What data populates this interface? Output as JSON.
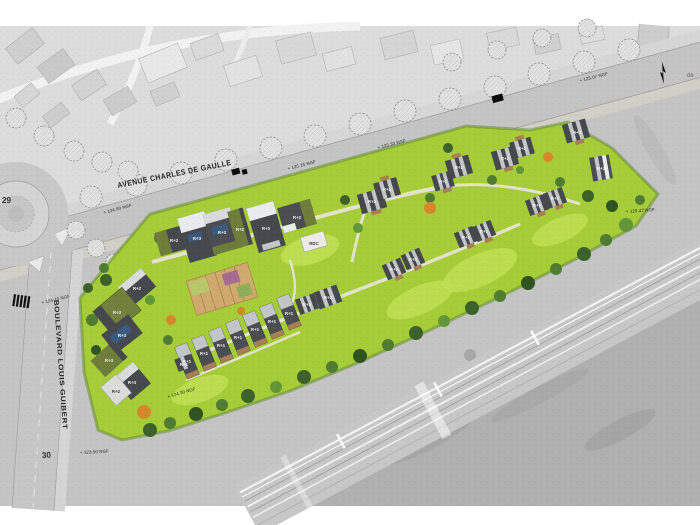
{
  "map": {
    "type": "architectural masterplan over grayscale aerial photo",
    "streets": {
      "avenue": "AVENUE CHARLES DE GAULLE",
      "boulevard": "BOULEVARD LOUIS GUIBERT",
      "roundabout_number": "29",
      "boulevard_number": "30",
      "right_edge_text": "de"
    },
    "elevation_markers": [
      "+ 124.90 NGF",
      "+ 125.15 NGF",
      "+ 125.33 NGF",
      "+ 125.07 NGF",
      "+ 125.47 NGF",
      "+ 124.70 NGF",
      "+ 124.30 NGF",
      "+ 123.50 NGF"
    ],
    "building_labels": [
      "R+2",
      "R+3",
      "R+3",
      "R+2",
      "R+3",
      "R+2",
      "RDC",
      "R+2",
      "R+2",
      "R+1",
      "R+2",
      "R+2",
      "R+2",
      "R+2",
      "R+3",
      "R+1",
      "R+1",
      "R+1",
      "R+1",
      "R+1",
      "R+1",
      "R+1",
      "R+2",
      "R+1",
      "R+1",
      "R+1",
      "R+1",
      "R+1",
      "R+1",
      "R+1",
      "R+2",
      "R+3",
      "R+3",
      "R+3",
      "R+3",
      "R+2",
      "R+1"
    ],
    "colors": {
      "site_green": "#a6cd37",
      "lawn_light": "#c2e156",
      "building_dark": "#45494d",
      "building_olive": "#6f7d3a",
      "solar_panel_blue": "#3a5a80",
      "autumn_orange": "#d4882b",
      "road_gray": "#c4c4c4"
    }
  }
}
